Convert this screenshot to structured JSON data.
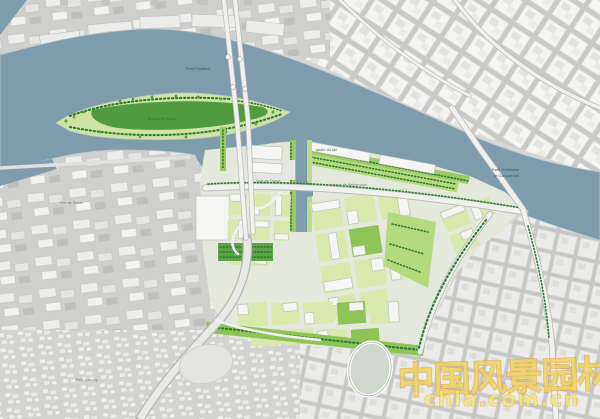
{
  "map": {
    "labels": {
      "pont_flaubert": "Pont Flaubert",
      "presquile_rollet": "Presqu'île Rollet",
      "jardin_du_rail": "jardin du rail",
      "quai_de_france": "Quai de France",
      "avenue_bethencourt": "Avenue de Béthencourt",
      "pont_guillaume_line1": "Pont Guillaume",
      "pont_guillaume_line2": "le Conquérant",
      "port_de_rouen": "Port de Rouen",
      "petit_quevilly": "Petit-Quevilly"
    },
    "colors": {
      "water": "#7E9DAC",
      "land": "#D6D6D4",
      "industrial": "#CDCDCB",
      "city_block": "#F5F5F3",
      "street": "#C6C6C4",
      "road": "#F0F0EE",
      "road_casing": "#B7B7B5",
      "district_base": "#E4E7DC",
      "island_lawn": "#4F9B3E",
      "park_mid": "#8CC455",
      "park_light": "#B4DA7E",
      "courtyard": "#D9E9AE",
      "quay_green": "#9CCB66",
      "tree_dark": "#2E7B33",
      "tree_bright": "#54A83C",
      "wm_yellow": "#F4E86E",
      "wm_orange": "#E2963C"
    }
  },
  "watermark": {
    "cjk": "中国风景园林网",
    "url": "chla.com.cn"
  }
}
